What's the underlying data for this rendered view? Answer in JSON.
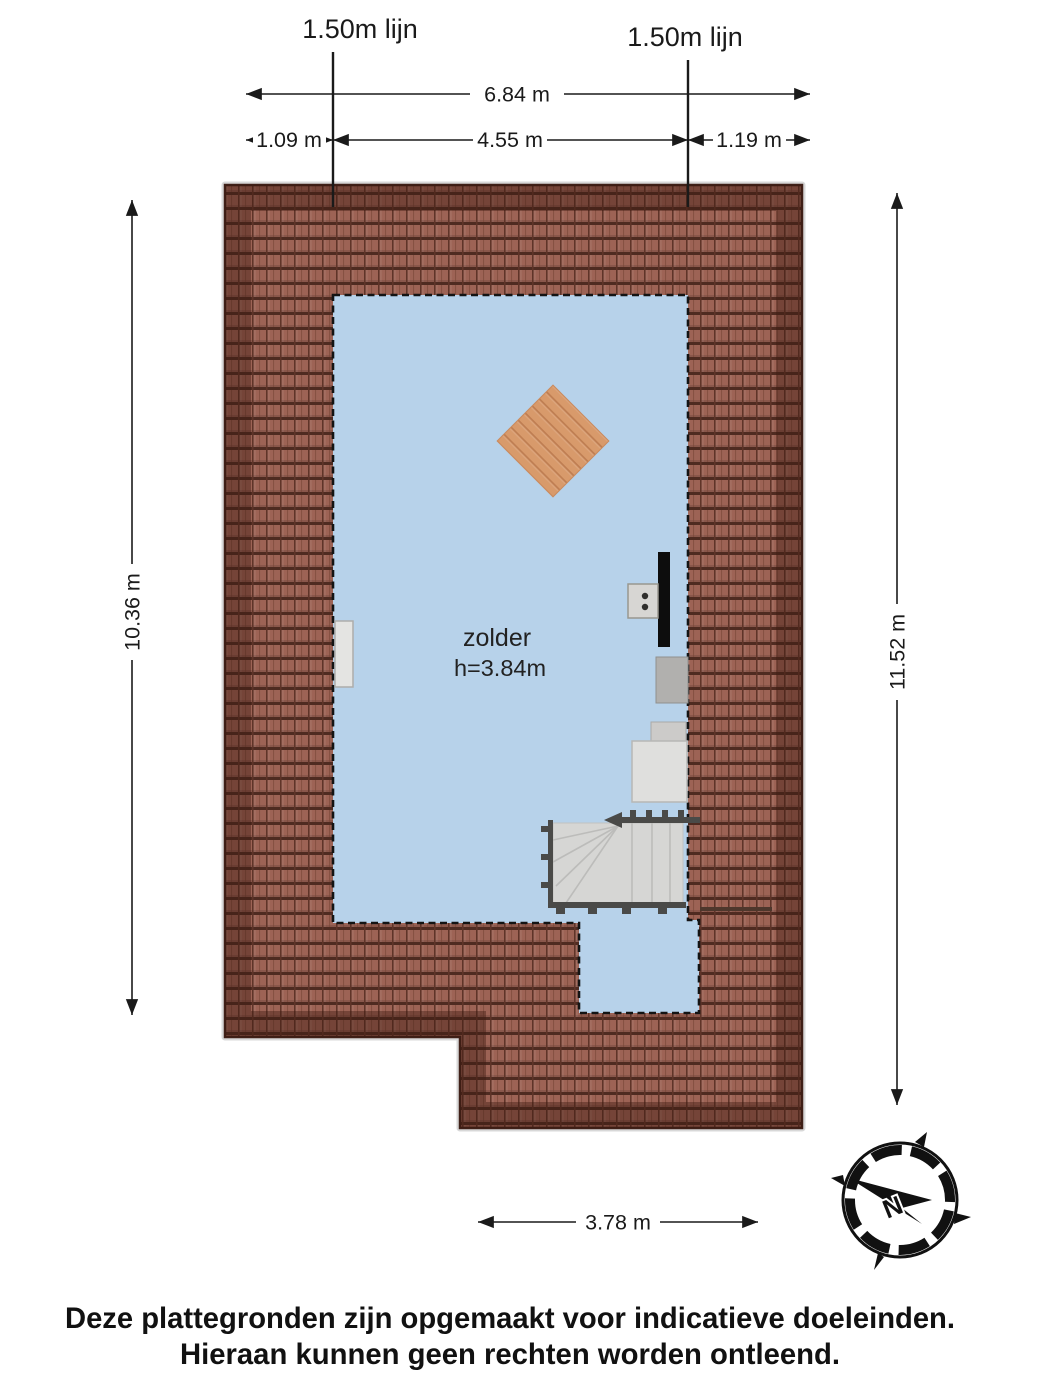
{
  "labels": {
    "line_left": "1.50m lijn",
    "line_right": "1.50m lijn"
  },
  "dimensions": {
    "total_width": "6.84 m",
    "left_offset": "1.09 m",
    "center_width": "4.55 m",
    "right_offset": "1.19 m",
    "height_left": "10.36 m",
    "height_right": "11.52 m",
    "bottom_width": "3.78 m"
  },
  "room": {
    "name": "zolder",
    "ceiling_height": "h=3.84m"
  },
  "compass": {
    "north": "N"
  },
  "disclaimer": {
    "line1": "Deze plattegronden zijn opgemaakt voor indicatieve doeleinden.",
    "line2": "Hieraan kunnen geen rechten worden ontleend."
  },
  "colors": {
    "roof_tile": "#9d6355",
    "roof_tile_joint": "#5f3428",
    "roof_tile_edge": "#4f2b21",
    "roof_band": "rgba(62,26,16,0.42)",
    "roof_outline": "#3f2018",
    "room_fill": "#b7d2ea",
    "wood_base": "#d89a6b",
    "wood_stripe": "#bf7e52",
    "stair_fill": "#d6d6d4",
    "railing": "#4a4a48",
    "ink": "#1a1a1a"
  }
}
